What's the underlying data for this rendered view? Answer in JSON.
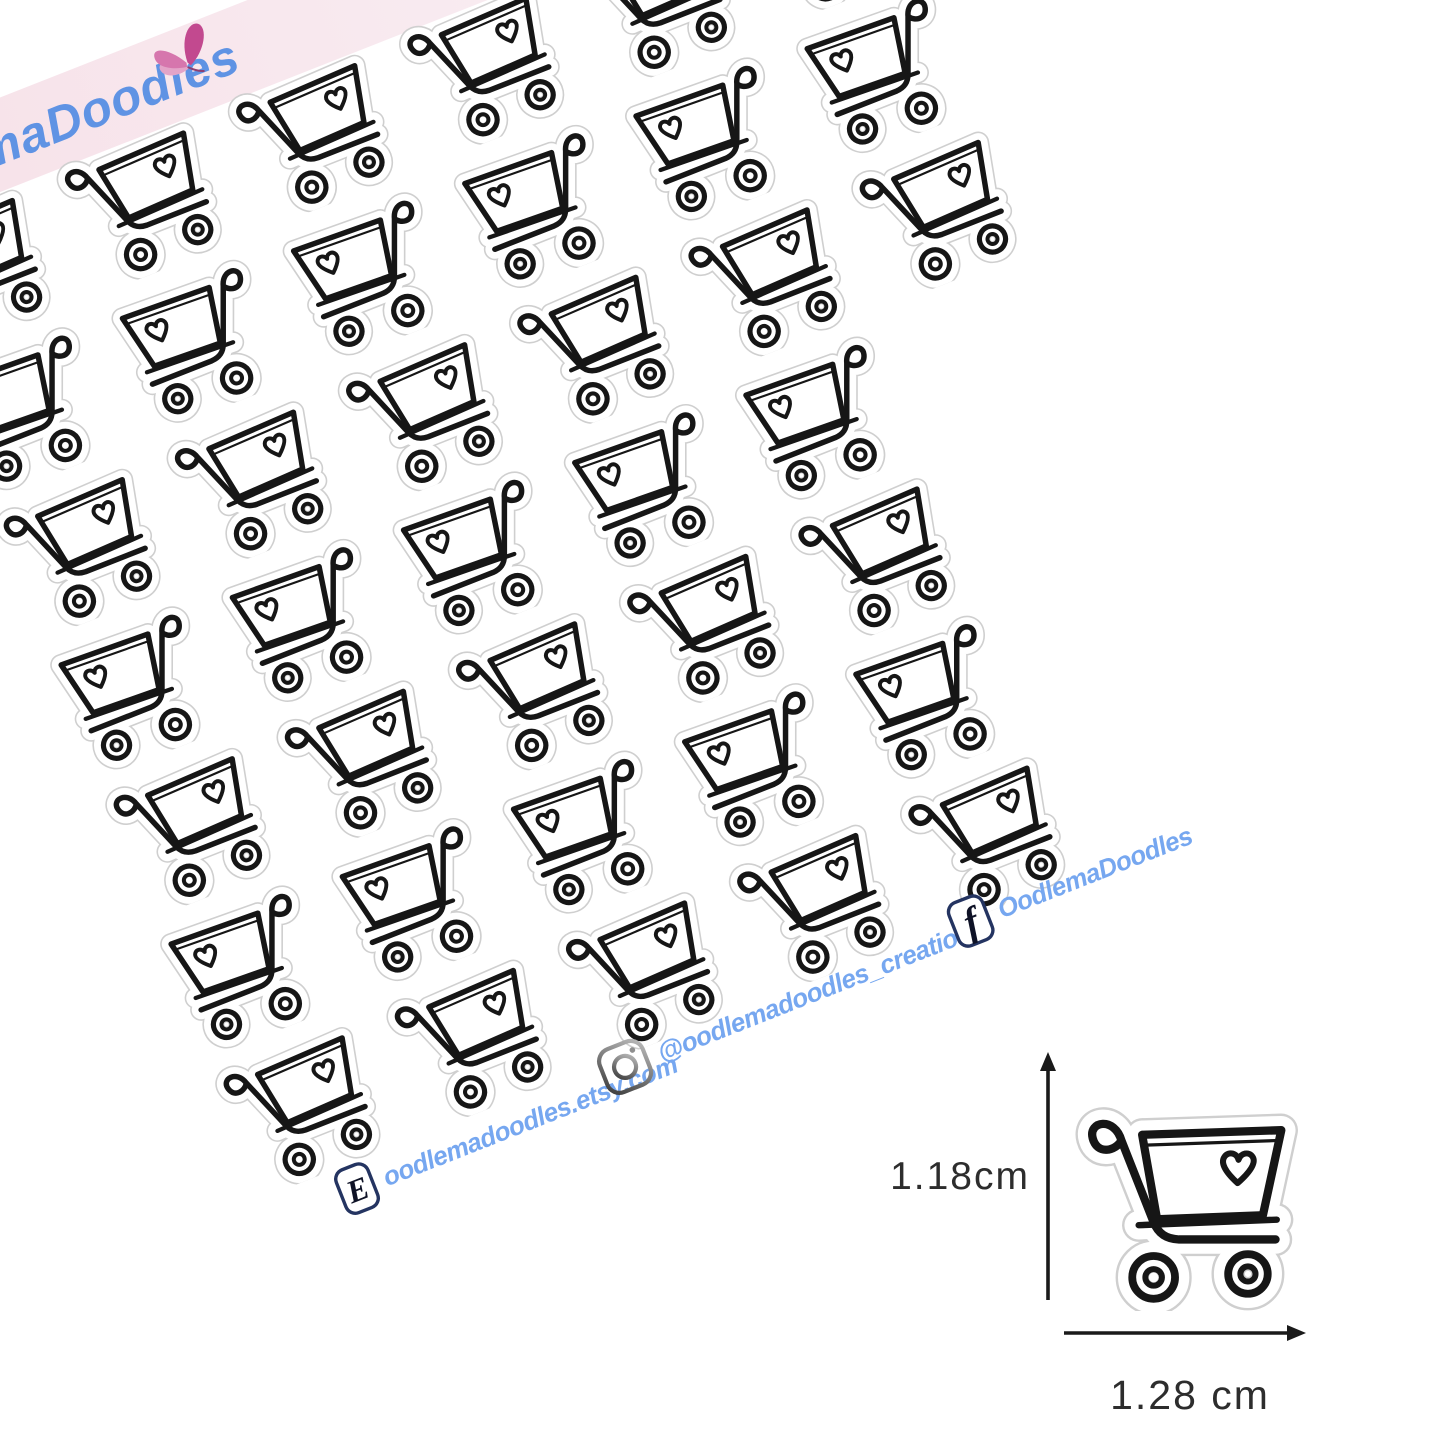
{
  "brand": {
    "logo_text": "OodlemaDoodles"
  },
  "banner": {
    "background": "#f6e1e9",
    "logo_color": "#5f93e4"
  },
  "sticker_sheet": {
    "design": "doodle shopping cart with heart",
    "rows": 7,
    "row_columns": [
      6,
      6,
      6,
      5,
      5,
      5,
      5
    ],
    "total_stickers": 38,
    "ink_color": "#161616",
    "cutline_color": "#cfcfcf"
  },
  "social": {
    "etsy": {
      "icon": "etsy-icon",
      "text": "oodlemadoodles.etsy.com"
    },
    "instagram": {
      "icon": "instagram-icon",
      "text": "@oodlemadoodles_creations"
    },
    "facebook": {
      "icon": "facebook-icon",
      "text": "OodlemaDoodles"
    }
  },
  "size_figure": {
    "height_label": "1.18cm",
    "width_label": "1.28 cm"
  },
  "colors": {
    "page_background": "#ffffff",
    "social_text": "#76a7f0",
    "dimension_text": "#2d2d2d",
    "icon_border_navy": "#243461",
    "icon_glyph": "#0e1226"
  }
}
